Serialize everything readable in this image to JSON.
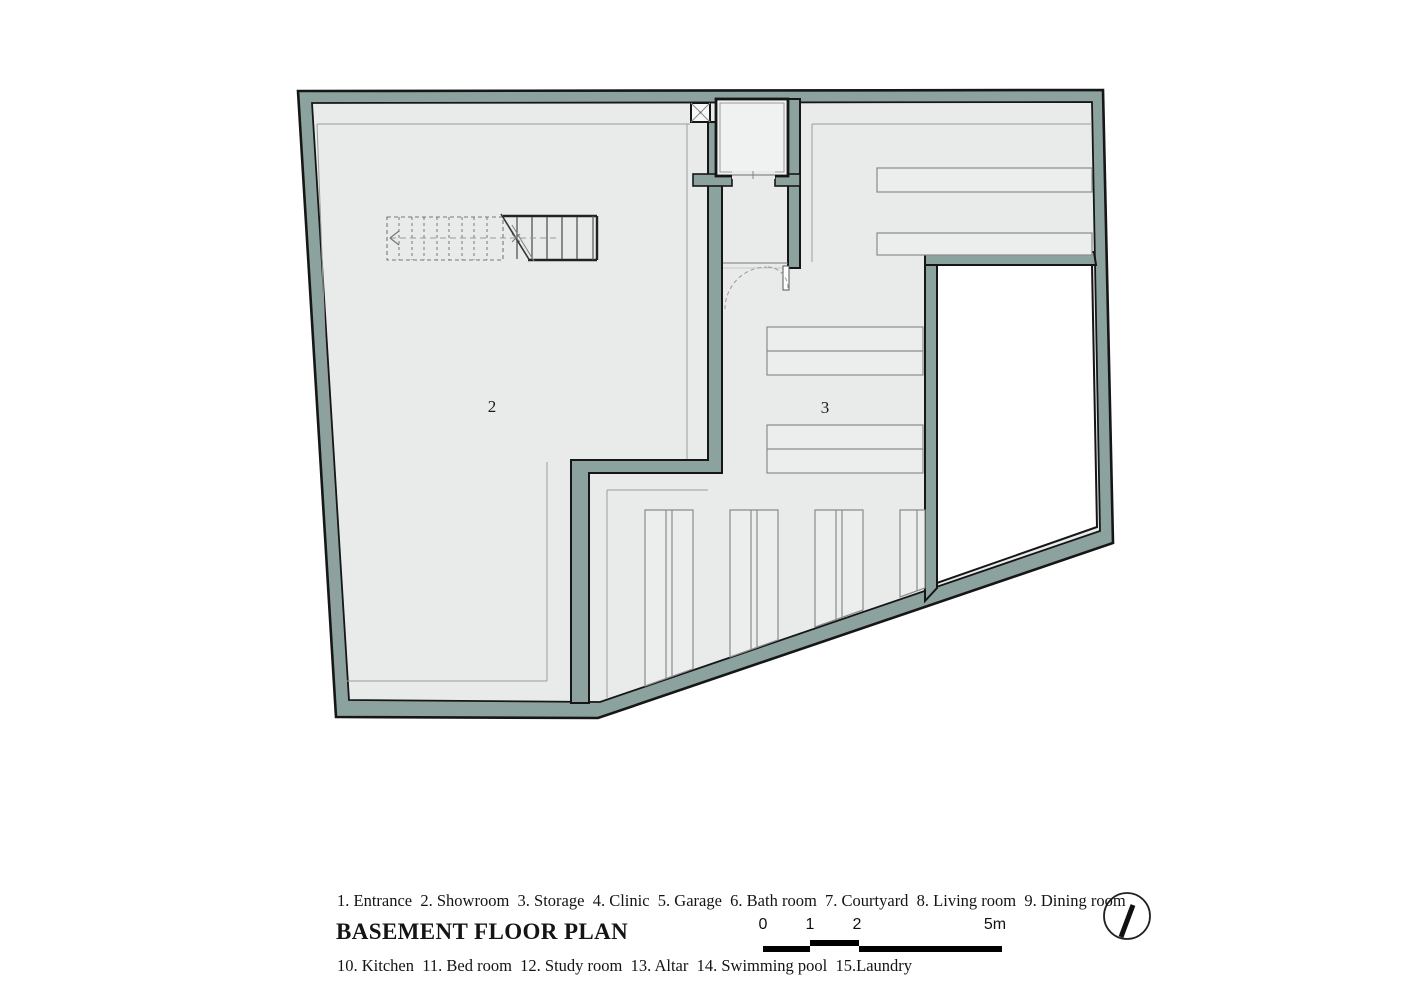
{
  "document": {
    "title": "BASEMENT FLOOR PLAN"
  },
  "plan": {
    "room_labels": [
      {
        "number": "2"
      },
      {
        "number": "3"
      }
    ]
  },
  "legend": {
    "line1": "1. Entrance  2. Showroom  3. Storage  4. Clinic  5. Garage  6. Bath room  7. Courtyard  8. Living room  9. Dining room",
    "line2": "10. Kitchen  11. Bed room  12. Study room  13. Altar  14. Swimming pool  15.Laundry"
  },
  "scale_bar": {
    "labels": [
      "0",
      "1",
      "2",
      "5m"
    ]
  },
  "icons": {
    "north_indicator": "north-indicator",
    "stairs": "stairs-symbol",
    "elevator": "elevator-symbol",
    "door_swing": "door-swing-symbol",
    "shaft": "duct-shaft-symbol"
  },
  "colors": {
    "wall_fill": "#8ca29e",
    "floor_fill": "#e9ebea",
    "outline": "#161616",
    "courtyard_fill": "#ffffff",
    "thin_line": "#9b9b9b",
    "scale_bar_fill": "#000000"
  }
}
